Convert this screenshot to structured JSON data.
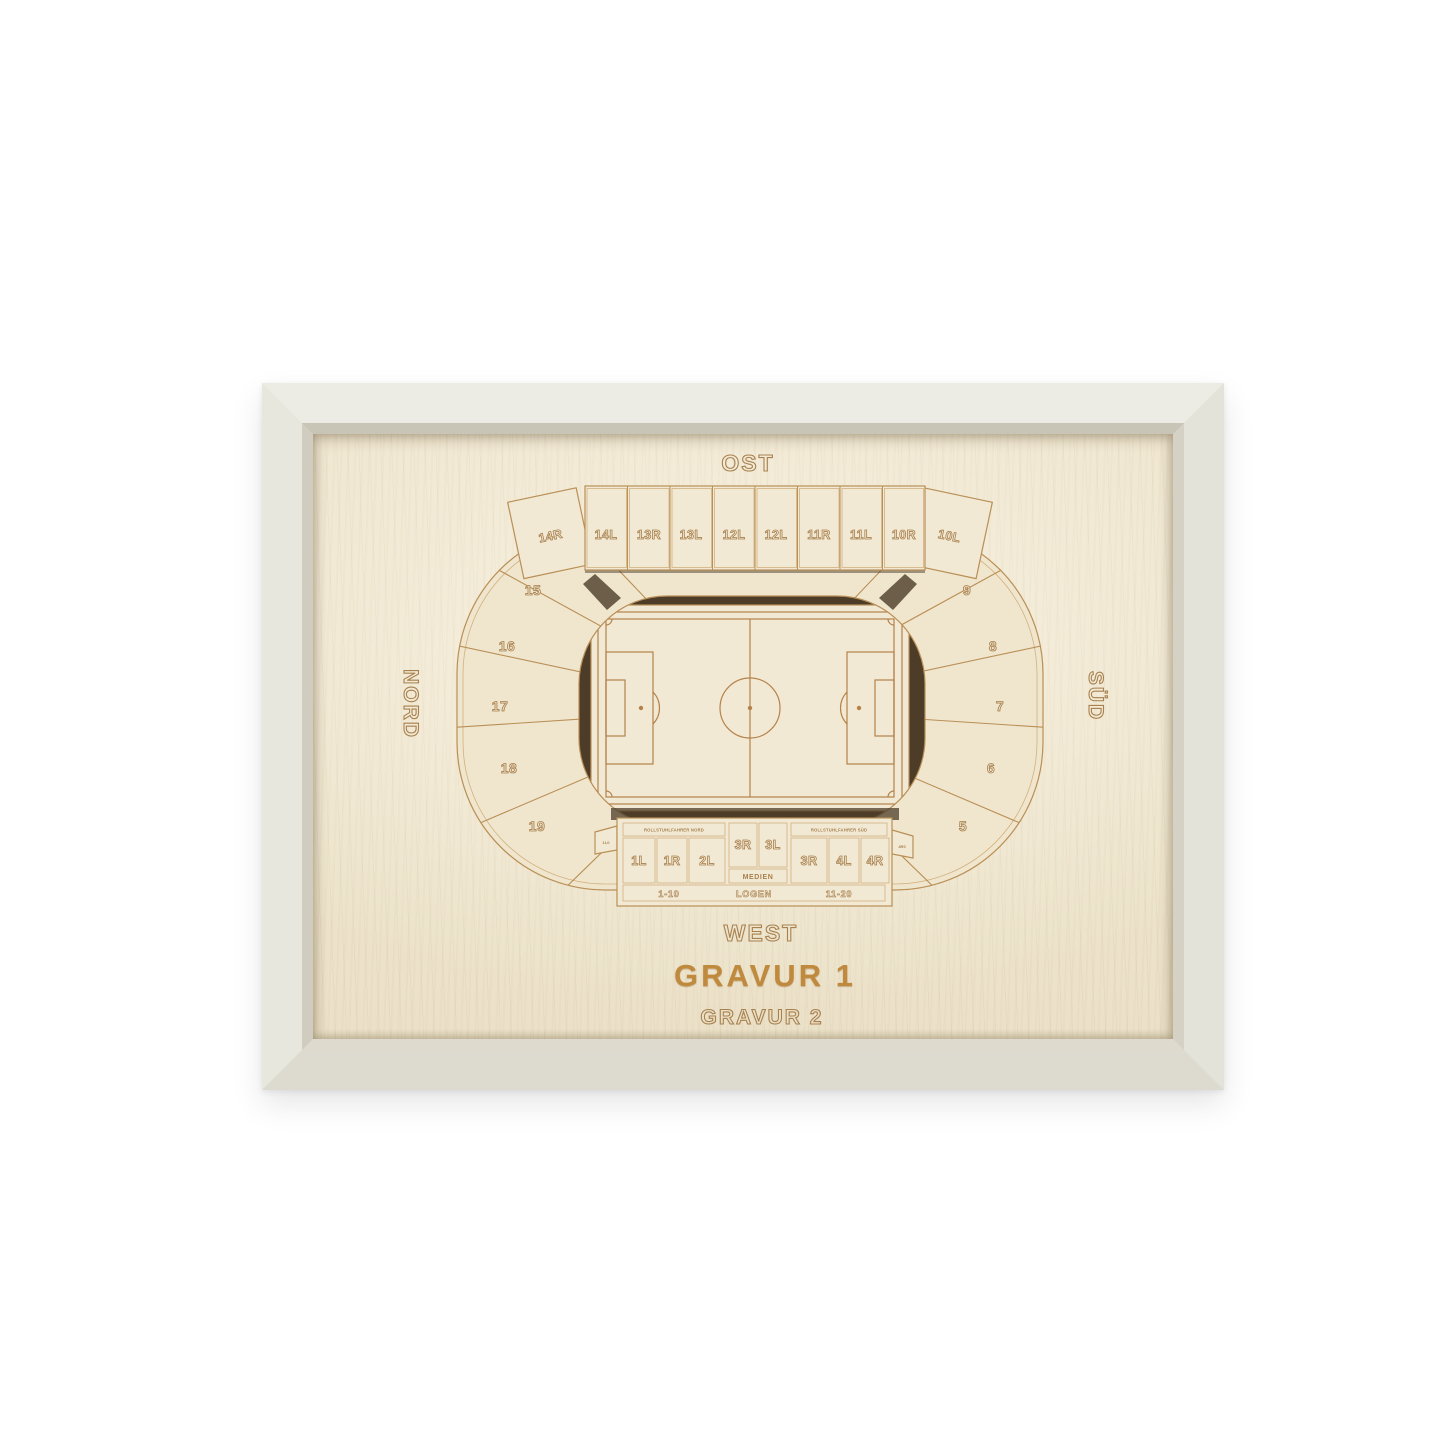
{
  "colors": {
    "frame": "#e9e8e0",
    "wood": "#efe6cf",
    "engraving": "#a8814f",
    "engraving_filled": "#c08a3e",
    "gap_shadow": "#4c3c28"
  },
  "compass": {
    "north": "NORD",
    "east": "OST",
    "south": "SÜD",
    "west": "WEST"
  },
  "engraving": {
    "line1": "GRAVUR 1",
    "line2": "GRAVUR 2"
  },
  "stadium": {
    "east_stand": {
      "cells": [
        "14L",
        "13R",
        "13L",
        "12L",
        "12L",
        "11R",
        "11L",
        "10R"
      ],
      "corner_left": "14R",
      "corner_right": "10L"
    },
    "north_arc": [
      "15",
      "16",
      "17",
      "18",
      "19"
    ],
    "south_arc": [
      "9",
      "8",
      "7",
      "6",
      "5"
    ],
    "west_stand": {
      "strip_left": "ROLLSTUHLFAHRER NORD",
      "strip_right": "ROLLSTUHLFAHRER SÜD",
      "cells_left": [
        "1L",
        "1R",
        "2L"
      ],
      "cells_mid": [
        "3R",
        "3L"
      ],
      "cells_right": [
        "3R",
        "4L",
        "4R"
      ],
      "media": "MEDIEN",
      "rows_left": "1-10",
      "logen": "LOGEN",
      "rows_right": "11-20",
      "tab_left": "1L0",
      "tab_right": "4R0"
    }
  }
}
